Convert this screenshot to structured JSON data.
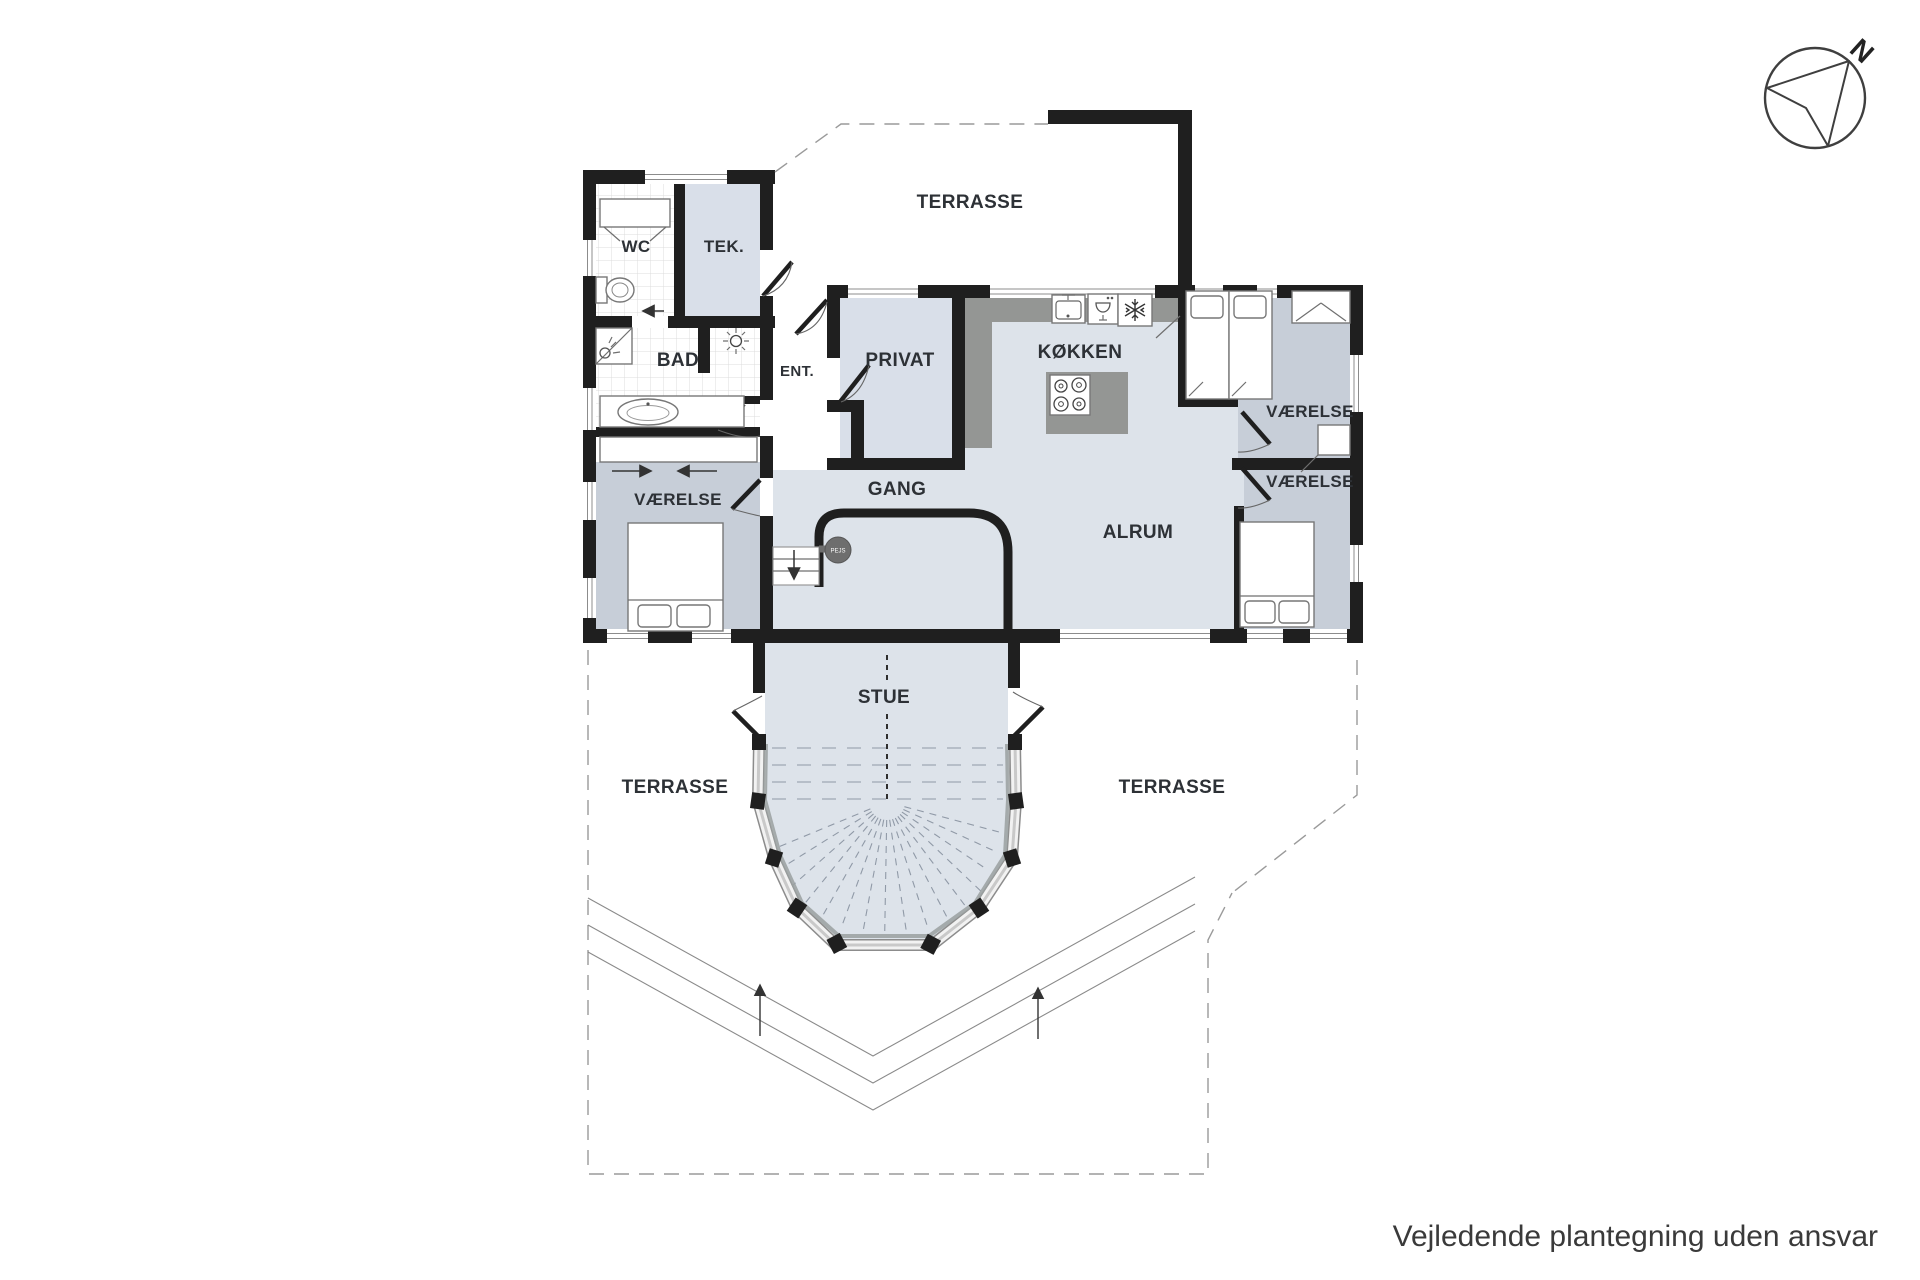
{
  "note": "Vejledende plantegning uden ansvar",
  "compass": {
    "north_label": "N"
  },
  "rooms": {
    "wc": "WC",
    "tek": "TEK.",
    "bad": "BAD",
    "ent": "ENT.",
    "privat": "PRIVAT",
    "kokken": "KØKKEN",
    "gang": "GANG",
    "alrum": "ALRUM",
    "stue": "STUE",
    "vaerelse_left": "VÆRELSE",
    "vaerelse_top_right": "VÆRELSE",
    "vaerelse_bottom_right": "VÆRELSE",
    "pejs": "PEJS"
  },
  "outdoor": {
    "terrasse_top": "TERRASSE",
    "terrasse_left": "TERRASSE",
    "terrasse_right": "TERRASSE"
  },
  "colors": {
    "wall": "#1f1f1f",
    "floor-light": "#dde3ea",
    "floor-room": "#d9dfe9",
    "floor-bedroom": "#c7ced8",
    "counter": "#949694",
    "pejs-fill": "#6e6e6e",
    "text": "#2d3136"
  }
}
